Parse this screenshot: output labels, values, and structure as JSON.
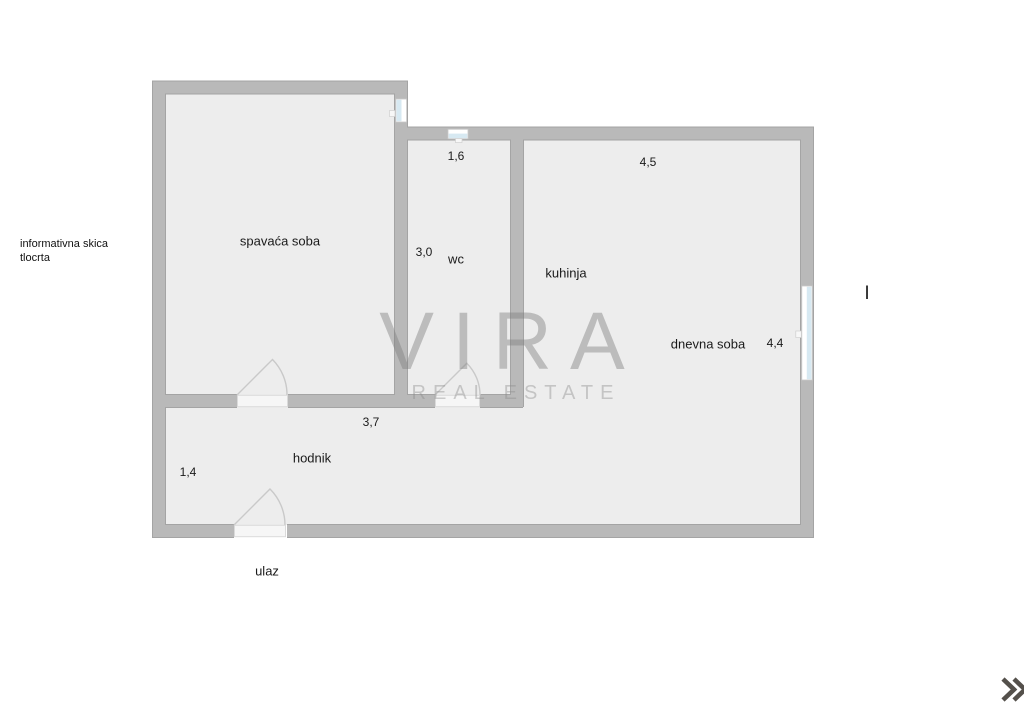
{
  "document": {
    "type": "floor-plan",
    "note": {
      "line1": "informativna skica",
      "line2": "tlocrta"
    },
    "floor_marker": "I"
  },
  "floorplan": {
    "rooms": [
      {
        "id": "spavaca-soba",
        "label": "spavaća soba"
      },
      {
        "id": "wc",
        "label": "wc"
      },
      {
        "id": "kuhinja",
        "label": "kuhinja"
      },
      {
        "id": "dnevna-soba",
        "label": "dnevna soba"
      },
      {
        "id": "hodnik",
        "label": "hodnik"
      }
    ],
    "entrance_label": "ulaz",
    "dimensions": [
      {
        "id": "wc-width",
        "value": "1,6"
      },
      {
        "id": "kuhinja-width",
        "value": "4,5"
      },
      {
        "id": "wc-depth",
        "value": "3,0"
      },
      {
        "id": "dnevna-soba-depth",
        "value": "4,4"
      },
      {
        "id": "hodnik-length",
        "value": "3,7"
      },
      {
        "id": "hodnik-width",
        "value": "1,4"
      }
    ],
    "colors": {
      "wall_fill": "#b9b9b9",
      "wall_outline": "#a4a4a4",
      "floor_fill": "#ededed",
      "window_glass": "#d7e9f2",
      "door_threshold": "#f6f6f6",
      "door_arc": "#c9c9c9"
    }
  },
  "watermark": {
    "line1": "VIRA",
    "line2": "REAL ESTATE"
  },
  "controls": {
    "next_icon_color": "#54504b"
  }
}
